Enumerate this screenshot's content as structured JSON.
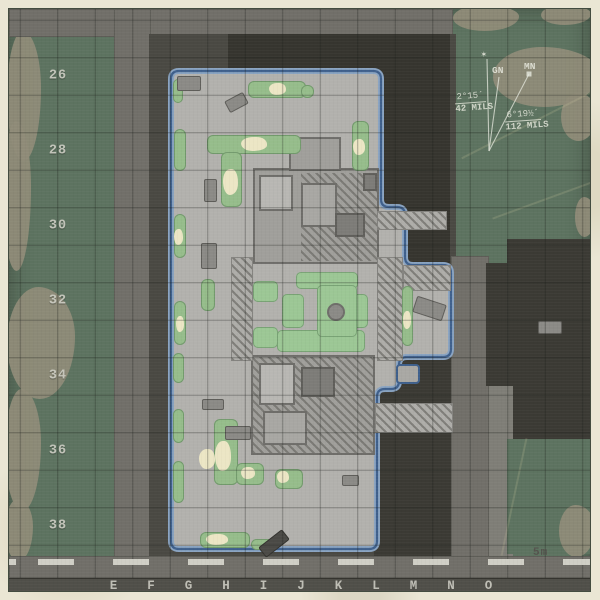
{
  "map": {
    "row_labels": [
      "26",
      "28",
      "30",
      "32",
      "34",
      "36",
      "38"
    ],
    "col_labels": [
      "E",
      "F",
      "G",
      "H",
      "I",
      "J",
      "K",
      "L",
      "M",
      "N",
      "O"
    ],
    "scale_label": "5m",
    "declination": {
      "star": "✶",
      "gn_label": "GN",
      "mn_label": "MN",
      "gn_angle": "2°15´",
      "gn_mils": "42 MILS",
      "mn_angle": "6°19½´",
      "mn_mils": "112 MILS"
    },
    "colors": {
      "paper": "#eae6d4",
      "terrain_green": "#5d7360",
      "terrain_tan": "#8f8b78",
      "road_gray": "#716f69",
      "building_charcoal": "#36352f",
      "compound_concrete": "#b2b1ad",
      "compound_outline_blue": "#3f608c",
      "bush_green": "#96bd8b",
      "sand_cream": "#ece6c5",
      "grid_label": "#c9c8bf"
    }
  }
}
